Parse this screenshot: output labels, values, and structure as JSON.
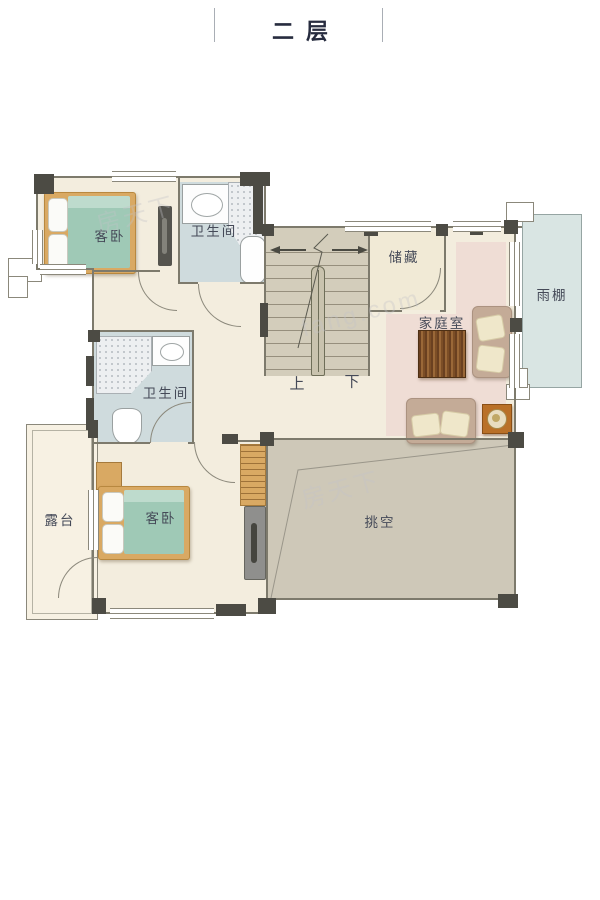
{
  "title": "二层",
  "watermarks": {
    "brand": "房天下",
    "site": "fang.com"
  },
  "rooms": {
    "bedroom_top": {
      "label": "客卧"
    },
    "bath_top": {
      "label": "卫生间"
    },
    "storage": {
      "label": "储藏"
    },
    "family": {
      "label": "家庭室"
    },
    "canopy": {
      "label": "雨棚"
    },
    "bath_mid": {
      "label": "卫生间"
    },
    "bedroom_bottom": {
      "label": "客卧"
    },
    "terrace": {
      "label": "露台"
    },
    "void": {
      "label": "挑空"
    }
  },
  "stairs": {
    "up": "上",
    "down": "下"
  },
  "colors": {
    "title": "#272c3f",
    "label": "#454a58",
    "floor": "#f3edde",
    "bath": "#cfdbdd",
    "stair": "#d3cdbb",
    "voidc": "#cec8b8",
    "canopy": "#d9e5e3",
    "rug": "#efddd5",
    "teal": "#9fc9b6",
    "tealLight": "#bedbcd",
    "wood": "#d9a963",
    "wall": "#4c4b44",
    "line": "#8b887b",
    "sofa": "#c4ab97",
    "cushion": "#efe7ca",
    "sidetable": "#b97028",
    "watermark": "rgba(195,195,200,0.35)"
  }
}
